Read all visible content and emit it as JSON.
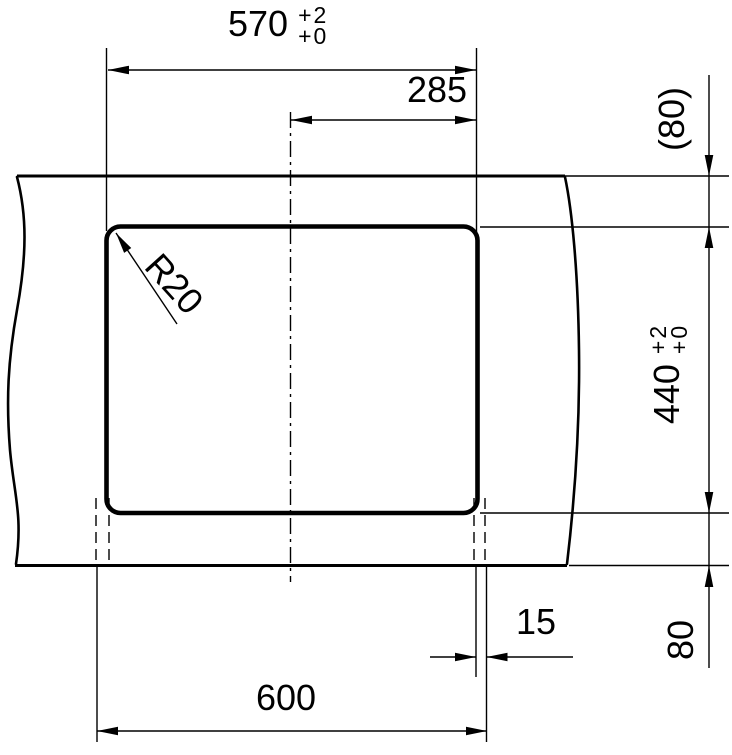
{
  "page": {
    "background_color": "#ffffff",
    "line_color": "#000000"
  },
  "drawing": {
    "kind": "technical dimension drawing",
    "subject": "rectangular cutout with rounded corners in a panel (break lines left and right)",
    "dimensions": {
      "cutout_width": {
        "value": "570",
        "tol_upper": "+2",
        "tol_lower": "+0"
      },
      "center_to_edge": {
        "value": "285"
      },
      "corner_radius": {
        "value": "R20"
      },
      "top_edge_distance": {
        "value": "(80)"
      },
      "cutout_height": {
        "value": "440",
        "tol_upper": "+2",
        "tol_lower": "+0"
      },
      "bottom_edge_distance": {
        "value": "80"
      },
      "side_offset": {
        "value": "15"
      },
      "overall_width": {
        "value": "600"
      }
    }
  }
}
